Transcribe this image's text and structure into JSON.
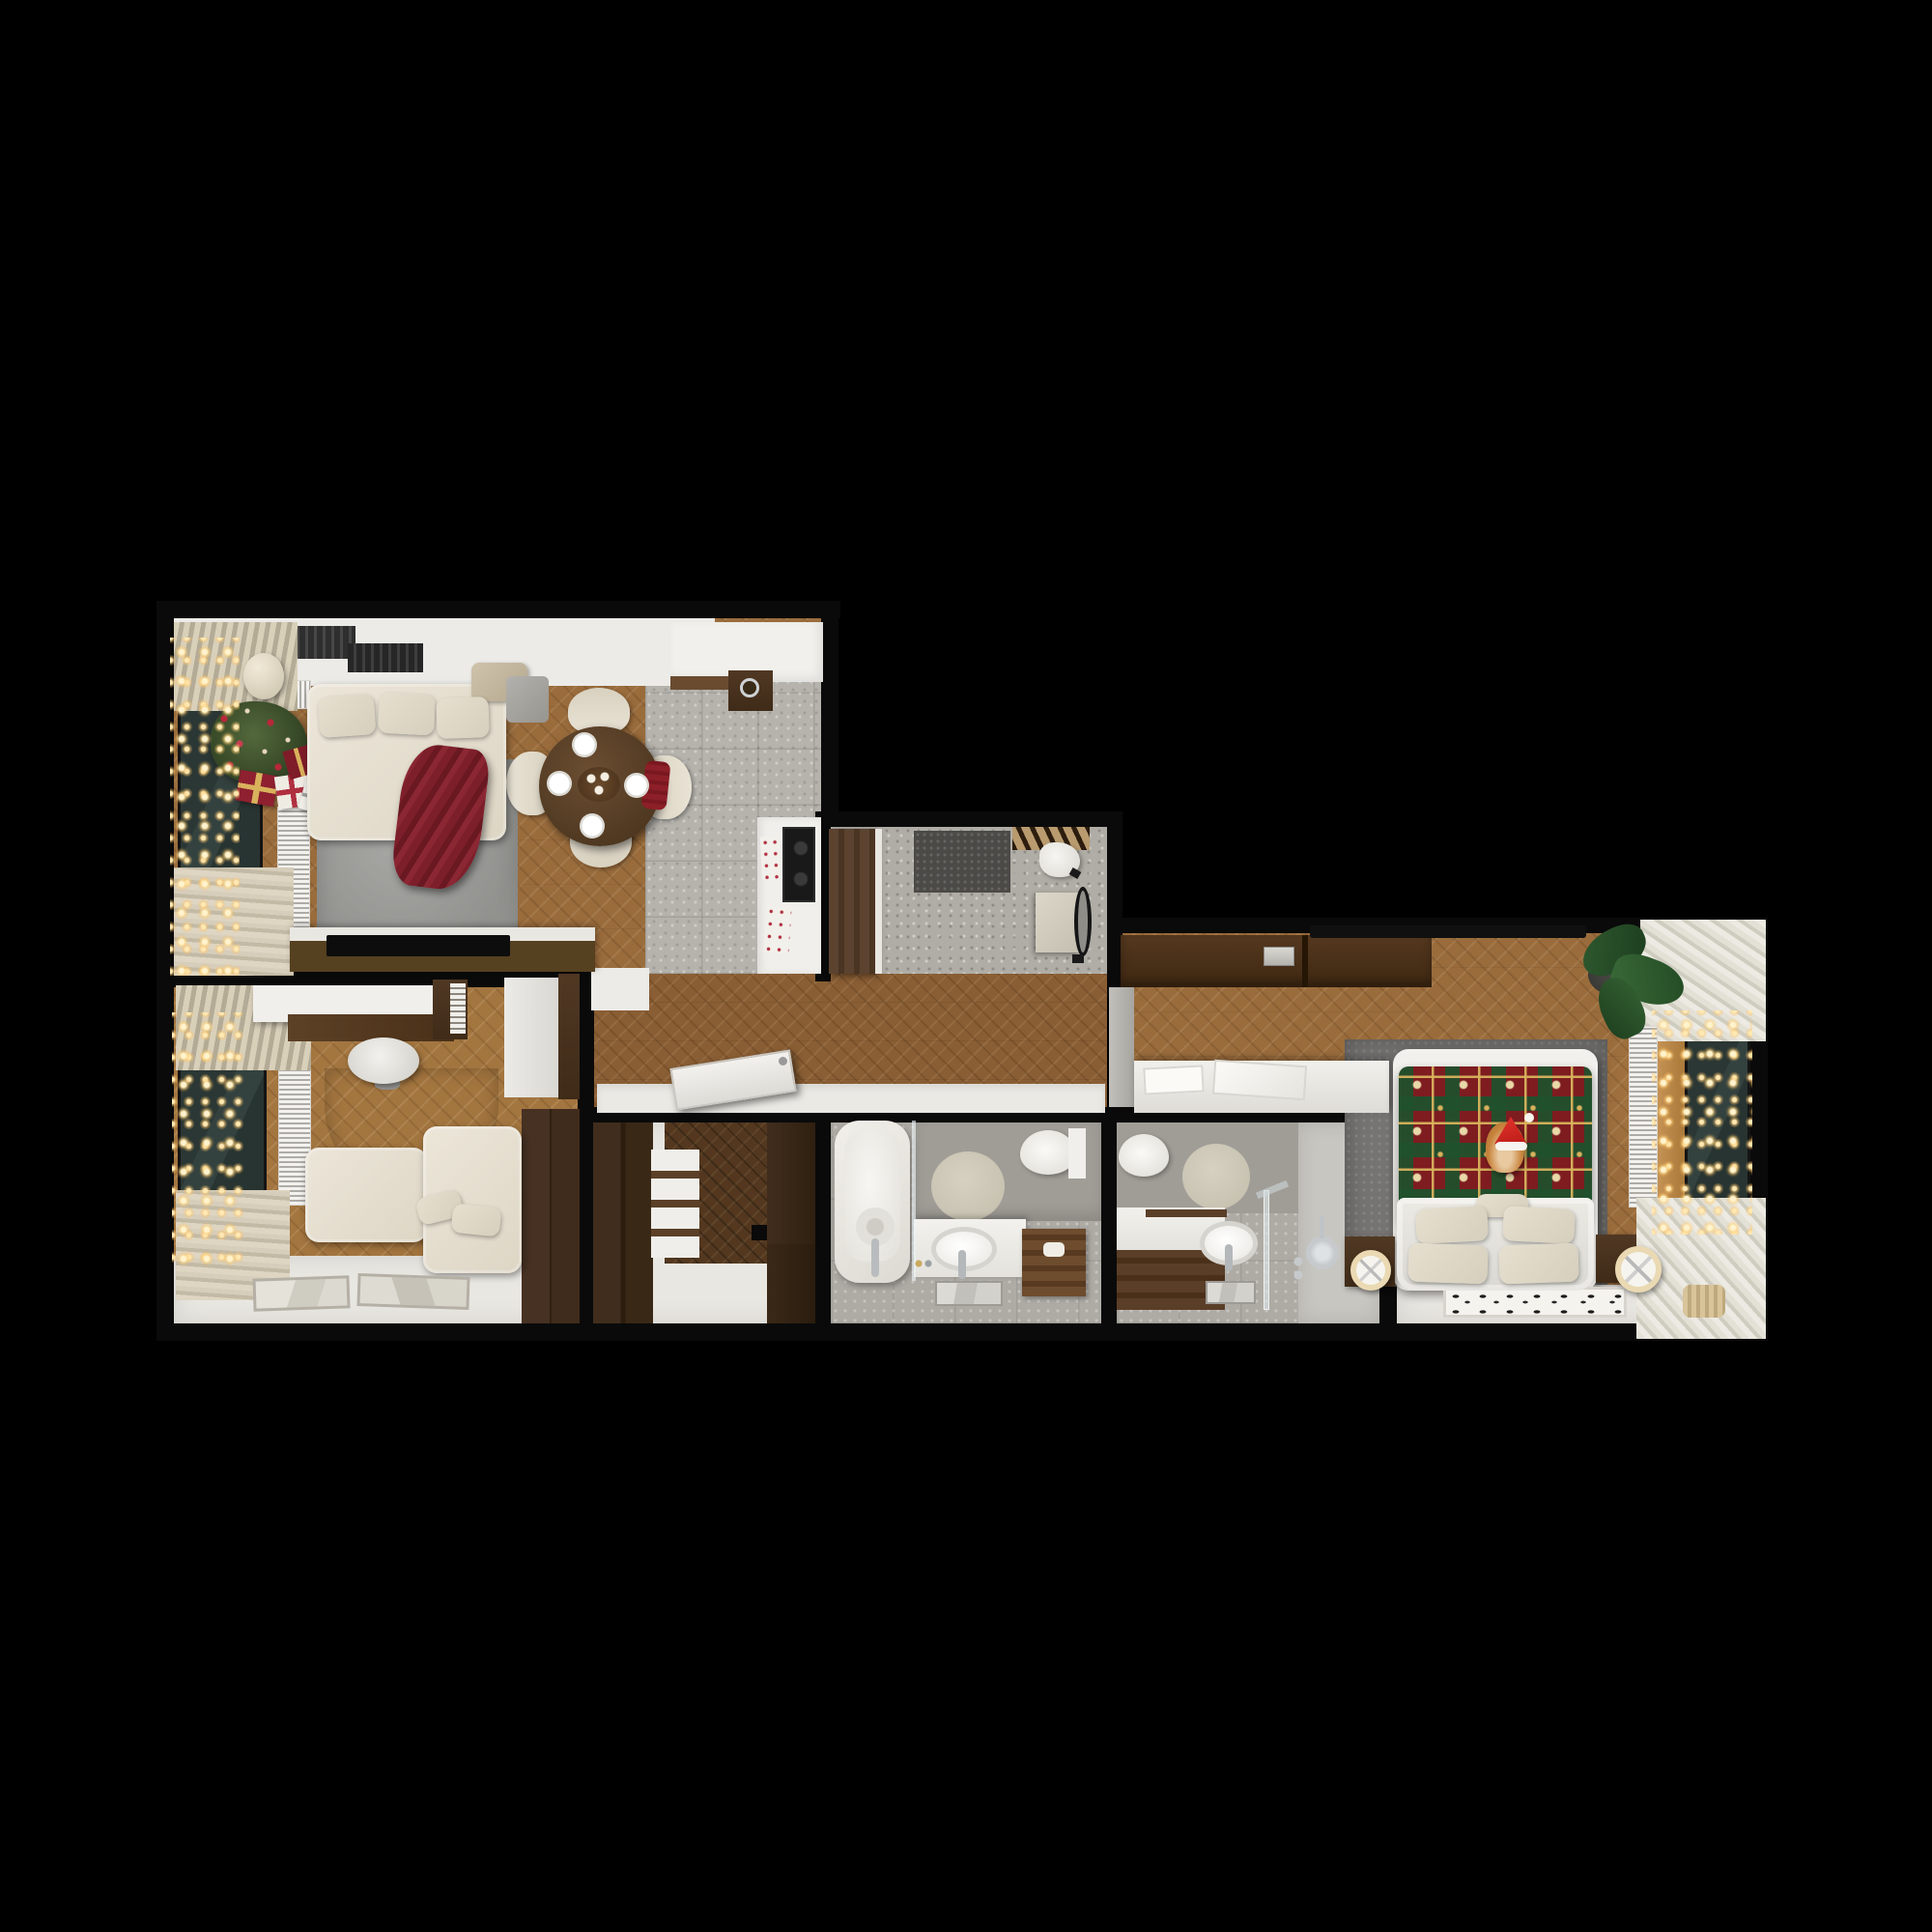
{
  "scene": {
    "type": "photorealistic top-down 3D floor plan render of an apartment, Christmas decorated",
    "background": "#000000",
    "rooms": [
      {
        "name": "living-room-kitchen",
        "floor": "light herringbone oak + grey tile kitchen zone",
        "items": [
          "white-corner-sofa",
          "red-knit-throw",
          "grey-area-rug",
          "christmas-tree-with-ornaments",
          "gift-boxes-red-white",
          "string-lights-garland",
          "window-dark-glass",
          "venetian-blinds",
          "beige-curtains",
          "slatted-radiators",
          "pendant-ball-lamp",
          "ceiling-vents",
          "round-walnut-dining-table",
          "four-white-chairs",
          "red-seat-pillow",
          "place-settings",
          "candle-centerpiece",
          "kitchen-counter-white",
          "walnut-sink-unit",
          "cooktop-black",
          "kitchen-towels",
          "tv-console",
          "flat-tv"
        ]
      },
      {
        "name": "home-office",
        "floor": "herringbone oak + white painted zone",
        "items": [
          "window-dark-glass",
          "string-lights-garland",
          "beige-curtains",
          "slatted-radiator",
          "white-desk-walnut-top",
          "desk-shelf-unit",
          "white-office-chair",
          "semicircle-grey-rug",
          "white-lounge-sofa",
          "throw-pillows",
          "two-framed-artworks-on-floor",
          "walnut-wardrobe",
          "white-tall-cabinet"
        ]
      },
      {
        "name": "entry-hall",
        "floor": "grey terrazzo",
        "items": [
          "walnut-entrance-door-open",
          "dark-grey-doormat",
          "coat-rack-hooks",
          "white-scarf",
          "beige-console-cabinet",
          "black-oval-mirror",
          "wall-hooks"
        ]
      },
      {
        "name": "hallway",
        "floor": "herringbone oak",
        "items": [
          "unhinged-white-door-leaning",
          "white-baseboard-band",
          "corner-partition"
        ]
      },
      {
        "name": "walk-in-closet",
        "floor": "dark herringbone + white zone",
        "items": [
          "dark-walnut-wardrobe-left",
          "dark-walnut-wardrobe-right",
          "white-shelf-unit-with-slats",
          "wall-stub"
        ]
      },
      {
        "name": "bathroom-with-tub",
        "floor": "grey stone tile",
        "items": [
          "bathtub-white",
          "glass-screen",
          "floor-mounted-faucet",
          "beige-round-rug",
          "wall-hung-toilet",
          "white-vanity",
          "oval-countertop-sink",
          "chrome-faucet",
          "mirror-reflection",
          "cosmetic-bottles",
          "wooden-towel-ladder",
          "towels"
        ]
      },
      {
        "name": "shower-room",
        "floor": "grey stone tile + light shower zone",
        "items": [
          "wall-hung-toilet",
          "white-vanity-walnut-front",
          "oval-countertop-sink",
          "chrome-faucet",
          "mirror-reflection",
          "glass-shower-screen",
          "round-shower-head",
          "shower-valves",
          "beige-round-rug"
        ]
      },
      {
        "name": "bedroom",
        "floor": "herringbone oak + white zone at foot wall",
        "items": [
          "double-bed",
          "christmas-plaid-blanket-snowflakes",
          "ginger-cat-santa-hat",
          "white-headboard",
          "four-beige-pillows",
          "small-center-pillow",
          "grey-area-rug",
          "walnut-nightstands",
          "ring-shaped-lamps",
          "walnut-low-wardrobe",
          "recessed-panel",
          "flat-tv-dark-bar",
          "potted-plant",
          "white-dressing-bench",
          "grey-partition",
          "slatted-radiator",
          "window-dark-glass",
          "string-lights-garland",
          "pleated-curtains-two-corners",
          "black-white-patterned-rug",
          "basket-decor"
        ]
      }
    ],
    "palette": {
      "background": "#000000",
      "walls": "#0a0a0a",
      "wood_light": "#9a6c3c",
      "wood_hall": "#8a5e34",
      "wood_dark_floor": "#53381f",
      "walnut_furniture": "#4a3323",
      "white_surface": "#efeeea",
      "white_floor": "#e9e7e2",
      "tile_grey": "#b6b3ad",
      "terrazzo": "#b0ada6",
      "bath_tile": "#aeaba5",
      "shower_zone": "#c8c6c1",
      "rug_grey": "#9b9b98",
      "bedroom_rug": "#767472",
      "round_rug_beige": "#cdc8b8",
      "sofa_cream": "#e7e1d4",
      "throw_red": "#7d1f2a",
      "tree_green": "#42582f",
      "gift_red": "#8e2030",
      "plaid_red": "#7e1c20",
      "plaid_green": "#1f512c",
      "plaid_gold": "#d8b25c",
      "plaid_cream": "#ead9a8",
      "cat_orange": "#c9853e",
      "santa_hat_red": "#d42420",
      "glass_window": "#2b3734",
      "garland_glow": "#ffe9b3",
      "curtain_beige": "#d5ccb9",
      "blinds_beige": "#d9d0ba",
      "radiator_white": "#f3f2ef",
      "mirror_black_frame": "#151515",
      "doormat_grey": "#4b4a47",
      "cooktop_black": "#191919"
    }
  }
}
